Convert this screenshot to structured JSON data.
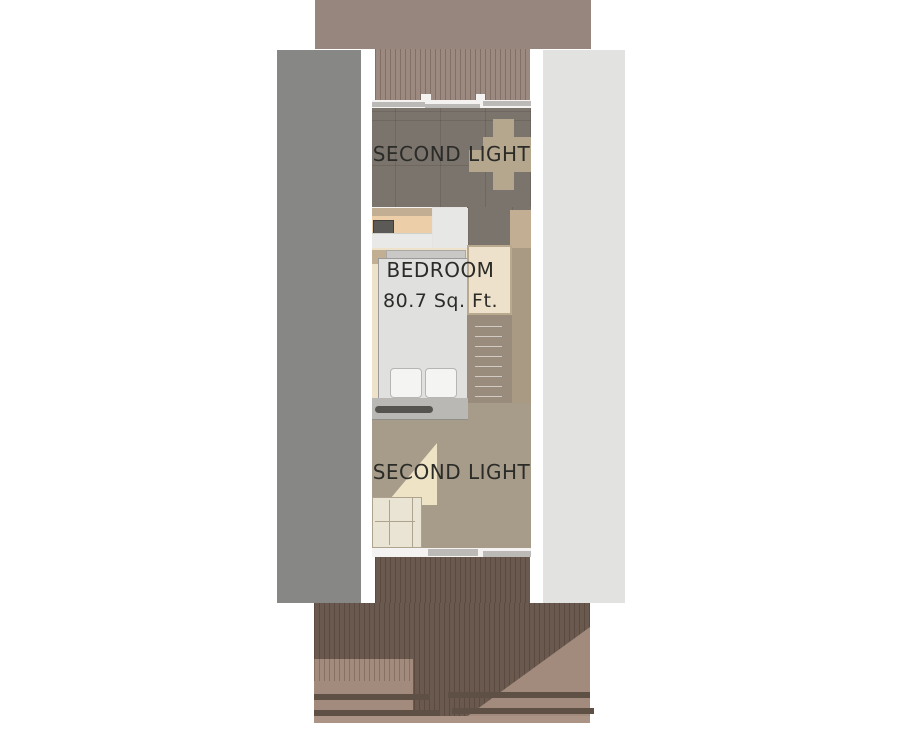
{
  "labels": {
    "upper_terrace": "SECOND LIGHT",
    "bedroom_name": "BEDROOM",
    "bedroom_area": "80.7 Sq. Ft.",
    "lower_living": "SECOND LIGHT"
  },
  "colors": {
    "roof": "#97867E",
    "deck_top": "#9C8A81",
    "deck_bottom": "#6A594F",
    "step_light": "#A28B7C",
    "step_dark": "#5F5046",
    "deck_edge": "#AB9486",
    "panel_left": "#878786",
    "panel_right": "#E2E2E1",
    "wall_white": "#F4F3F1",
    "window_gray": "#BBBAB7",
    "tile_floor": "#7B746C",
    "furniture_tan": "#B5A68E",
    "counter_tan": "#C2AE93",
    "counter_peach": "#ECCFA9",
    "stove": "#5B5A56",
    "cabinet_white": "#E9E9E7",
    "column_white": "#E7E7E5",
    "bedroom_floor": "#EFE2CB",
    "headboard": "#C9C8C6",
    "bed": "#E0E0DE",
    "pillow": "#F4F4F2",
    "wardrobe": "#EDE1CB",
    "wardrobe_frame": "#B9A98E",
    "stairs": "#9A8C7C",
    "right_strip": "#A89A83",
    "loft_band": "#B9B8B5",
    "fan": "#55544F",
    "living_floor": "#A79C8A",
    "accent_cream": "#EFE3C6",
    "sofa": "#EAE4D5",
    "sofa_line": "#ADA38E",
    "label_text": "#2B2B28"
  }
}
